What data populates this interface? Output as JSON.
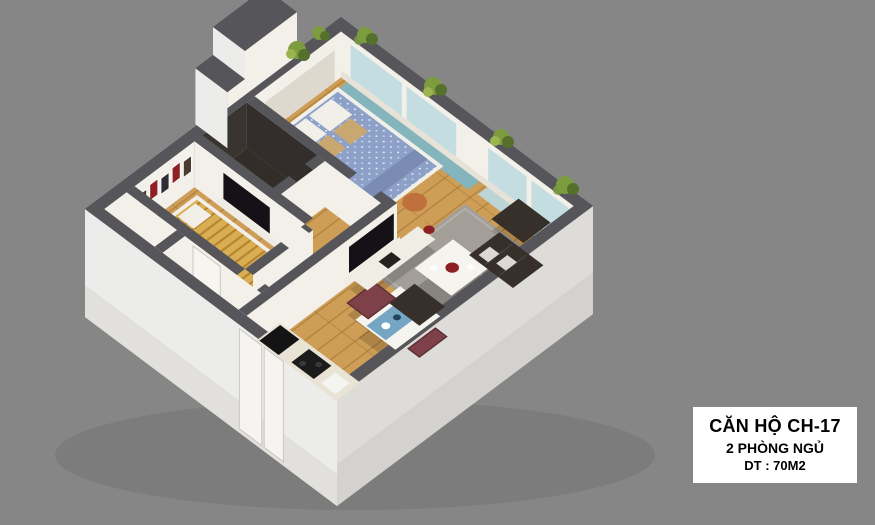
{
  "label_card": {
    "line1": "CĂN HỘ CH-17",
    "line2": "2 PHÒNG NGỦ",
    "line3": "DT : 70M2"
  },
  "colors": {
    "bg": "#868686",
    "card": "#ffffff",
    "card_text": "#000000",
    "wall_cap": "#55555a",
    "wall_interior": "#f3f0e9",
    "wall_exterior_light": "#ececea",
    "wall_exterior_shade": "#dedcd8",
    "floor_wood": "#cf9e56",
    "floor_wood_line": "#8a6226",
    "floor_tile": "#d9d1c2",
    "floor_dark": "#332d29",
    "rug": "#a39e98",
    "sofa": "#362f2a",
    "bed_blue": "#8ca0c8",
    "mat_yellow": "#d9ae52",
    "mat_stripe": "#b4832e",
    "pillow_white": "#f2efe9",
    "pillow_tan": "#c9a771",
    "chair_burgundy": "#7e4049",
    "table_white": "#f6f4ee",
    "runner_blue": "#74a5c2",
    "accent_red": "#8e1f24",
    "teal_floor": "#84b5bd",
    "window_glass": "#c3dde0",
    "plant_green": "#7c9c3f",
    "plant_green_dark": "#55702a",
    "pouf_orange": "#c0703c",
    "tv_black": "#141216",
    "counter_top": "#e9e3d6"
  }
}
